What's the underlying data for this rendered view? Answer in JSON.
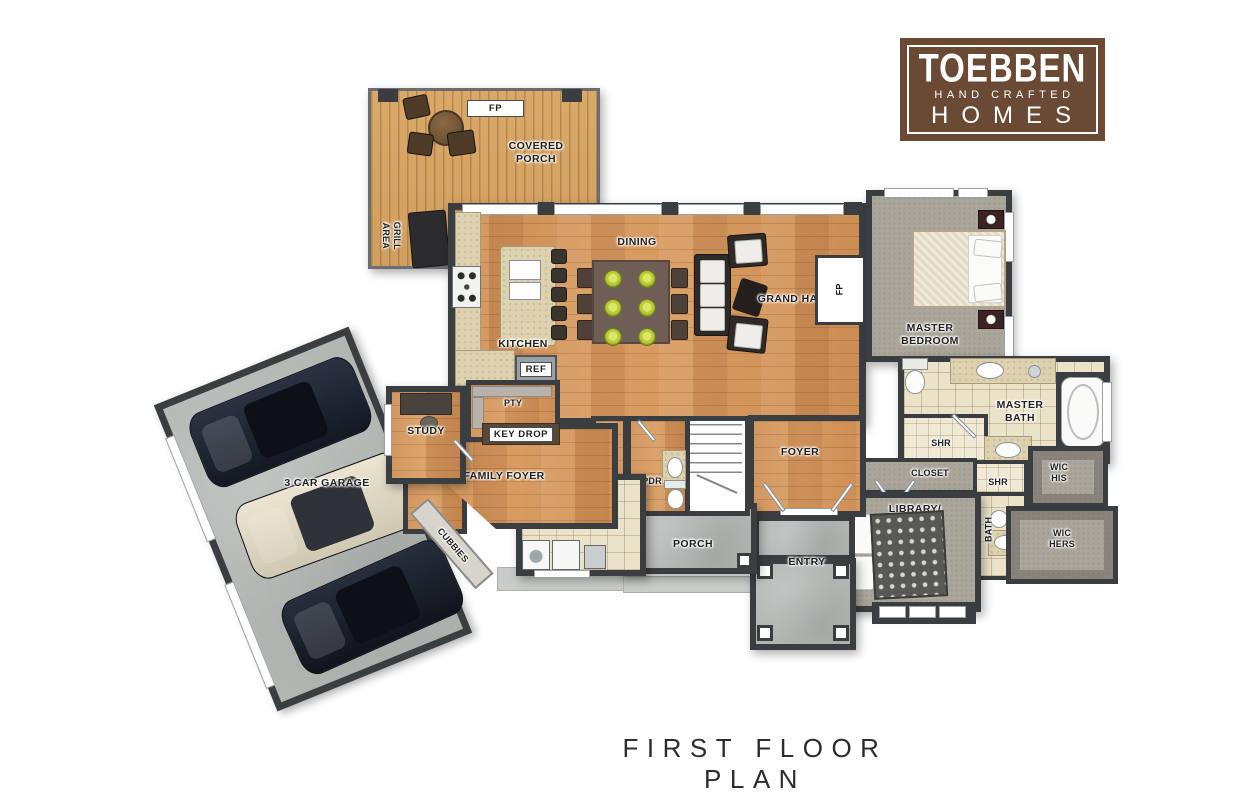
{
  "title": "FIRST FLOOR PLAN",
  "logo": {
    "brand": "TOEBBEN",
    "tagline": "HAND CRAFTED",
    "word": "HOMES"
  },
  "rooms": {
    "covered_porch": "COVERED PORCH",
    "grill_area": "GRILL AREA",
    "dining": "DINING",
    "kitchen": "KITCHEN",
    "grand_hall": "GRAND HALL",
    "master_bedroom": "MASTER BEDROOM",
    "master_bath": "MASTER BATH",
    "wic_his": "WIC HIS",
    "wic_hers": "WIC HERS",
    "library_bedroom": "LIBRARY/ BEDROOM",
    "closet_hall": "CLOSET",
    "closet_mud": "CLOSET",
    "shr_master": "SHR",
    "shr_hall": "SHR",
    "bath": "BATH",
    "foyer": "FOYER",
    "entry": "ENTRY",
    "porch": "PORCH",
    "laundry": "LAUNDRY",
    "pdr": "PDR",
    "family_foyer": "FAMILY FOYER",
    "study": "STUDY",
    "pty": "PTY",
    "cubbies": "CUBBIES",
    "garage": "3 CAR GARAGE"
  },
  "tags": {
    "fireplace_porch": "FP",
    "fireplace_hall": "FP",
    "refrigerator": "REF",
    "key_drop": "KEY DROP"
  },
  "colors": {
    "wall": "#3b3e41",
    "wood": "#cd8e55",
    "deck": "#d9a969",
    "carpet": "#aba69b",
    "concrete": "#b2b6b3",
    "tile": "#ebe2ca",
    "counter": "#ddd2b0",
    "plate": "#b9c938",
    "logo": "#6b4a35"
  }
}
